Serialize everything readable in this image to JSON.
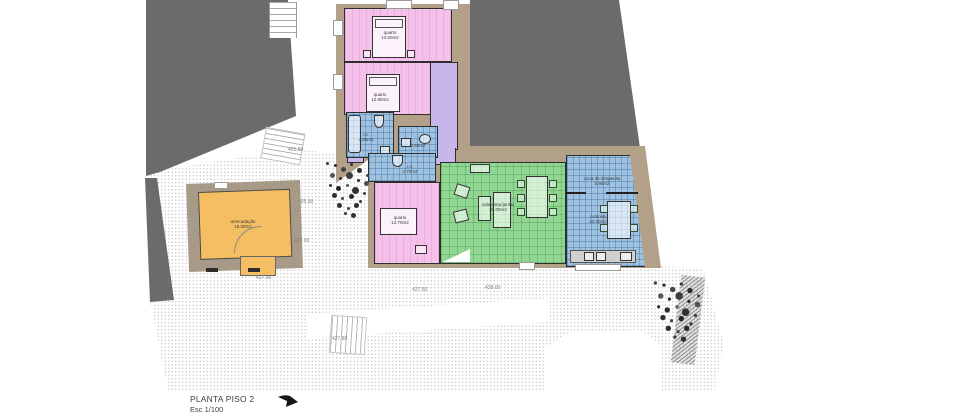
{
  "drawing": {
    "title": "PLANTA PISO 2",
    "scale": "Esc 1/100"
  },
  "rooms": {
    "quarto1": {
      "name": "quarto",
      "area": "13.50m2"
    },
    "quarto2": {
      "name": "quarto",
      "area": "12.90m2"
    },
    "quarto3": {
      "name": "quarto",
      "area": "13.70m2"
    },
    "is1": {
      "name": "i.s.",
      "area": "4.90m2"
    },
    "is2": {
      "name": "i.s.",
      "area": "3.60m2"
    },
    "is3": {
      "name": "i.s.",
      "area": "4.70m2"
    },
    "sala": {
      "name": "sala estar/jantar",
      "area": "30.00m2"
    },
    "despensa": {
      "name": "zona de despensa",
      "area": "5.90m2"
    },
    "cozinha": {
      "name": "cozinha",
      "area": "13.00m2"
    },
    "arrecadacao": {
      "name": "arrecadação",
      "area": "18.00m2"
    }
  },
  "elevations": {
    "e1": "421.50",
    "e2": "425.00",
    "e3": "427.00",
    "e4": "427.50",
    "e5": "427.60",
    "e6": "428.00",
    "e7": "427.80"
  },
  "colors": {
    "pink": "#f5c0e9",
    "purple": "#c7b6ea",
    "blue": "#9fc2e0",
    "green": "#92d694",
    "orange": "#f6be62",
    "wall": "#b2a188",
    "wall_dark": "#a89a89",
    "neighbor": "#6b6b6b",
    "ground_dot": "#c9c9c9"
  },
  "icons": {
    "tree": "scribble-canopy",
    "bed": "rect-with-pillow",
    "bathtub": "rounded-rect",
    "toilet": "oval-with-tank",
    "sink": "small-rect",
    "sofa": "rect-outline",
    "armchair": "rotated-square",
    "dining_table": "rect-with-chairs",
    "north_arrow": "➤"
  }
}
